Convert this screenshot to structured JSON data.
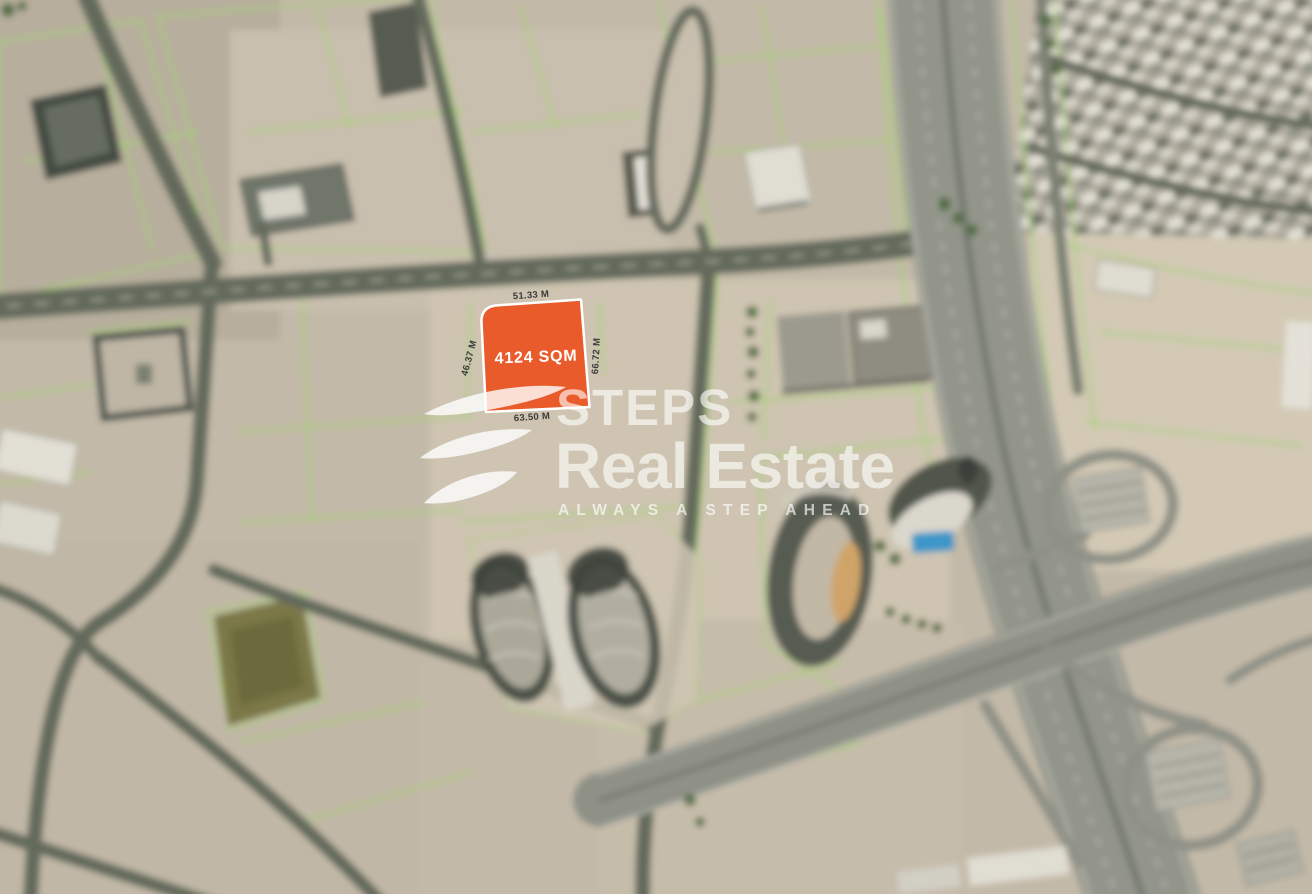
{
  "plot": {
    "area_label": "4124 SQM",
    "dim_top": "51.33 M",
    "dim_left": "46.37 M",
    "dim_right": "66.72 M",
    "dim_bottom": "63.50 M",
    "fill_color": "#E95B2B",
    "stroke_color": "#FFFFFF"
  },
  "watermark": {
    "brand_line1": "STEPS",
    "brand_line2": "Real Estate",
    "tagline": "ALWAYS A STEP AHEAD"
  },
  "map": {
    "ground_color": "#C3B9A8",
    "parcel_line_color": "#9FD468",
    "road_color": "#646B5C",
    "highway_color": "#93958B",
    "pool_color": "#3E97C8"
  }
}
